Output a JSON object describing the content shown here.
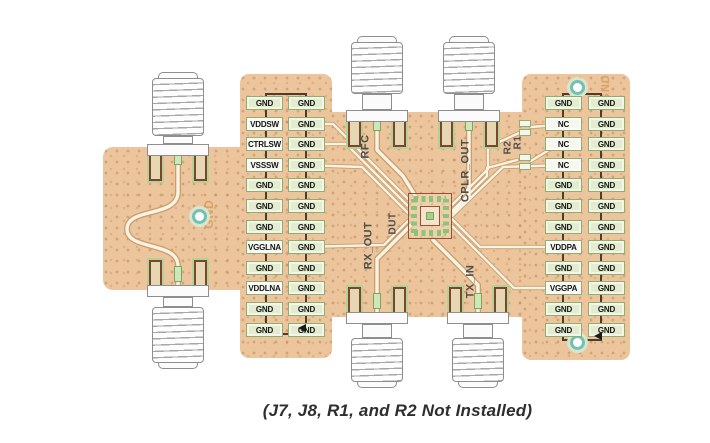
{
  "caption": "(J7, J8, R1, and R2 Not Installed)",
  "left_header": {
    "signals": [
      "GND",
      "VDDSW",
      "CTRLSW",
      "VSSSW",
      "GND",
      "GND",
      "GND",
      "VGGLNA",
      "GND",
      "VDDLNA",
      "GND",
      "GND"
    ],
    "gnd": [
      "GND",
      "GND",
      "GND",
      "GND",
      "GND",
      "GND",
      "GND",
      "GND",
      "GND",
      "GND",
      "GND",
      "GND"
    ]
  },
  "right_header": {
    "signals": [
      "GND",
      "NC",
      "NC",
      "NC",
      "GND",
      "GND",
      "GND",
      "VDDPA",
      "GND",
      "VGGPA",
      "GND",
      "GND"
    ],
    "gnd": [
      "GND",
      "GND",
      "GND",
      "GND",
      "GND",
      "GND",
      "GND",
      "GND",
      "GND",
      "GND",
      "GND",
      "GND"
    ]
  },
  "silkscreen": {
    "rfc": "RFC",
    "cplr_out": "CPLR_OUT",
    "r2": "R2",
    "r1": "R1",
    "rx_out": "RX_OUT",
    "dut": "DUT",
    "tx_in": "TX_IN"
  },
  "copper_text": {
    "left_gnd": "GND",
    "top_right_gnd": "GND"
  },
  "colors": {
    "board_copper": "#ecc59c",
    "pad_green": "#e3eccf",
    "pad_white": "#f6f7f1",
    "silkscreen": "#4f4f4f",
    "copper_label": "#d7a267",
    "via_ring": "#76c0b2",
    "footprint_outline": "#7a4632",
    "trace_core": "#f9f3e6",
    "header_outline": "#4c3d2d"
  }
}
